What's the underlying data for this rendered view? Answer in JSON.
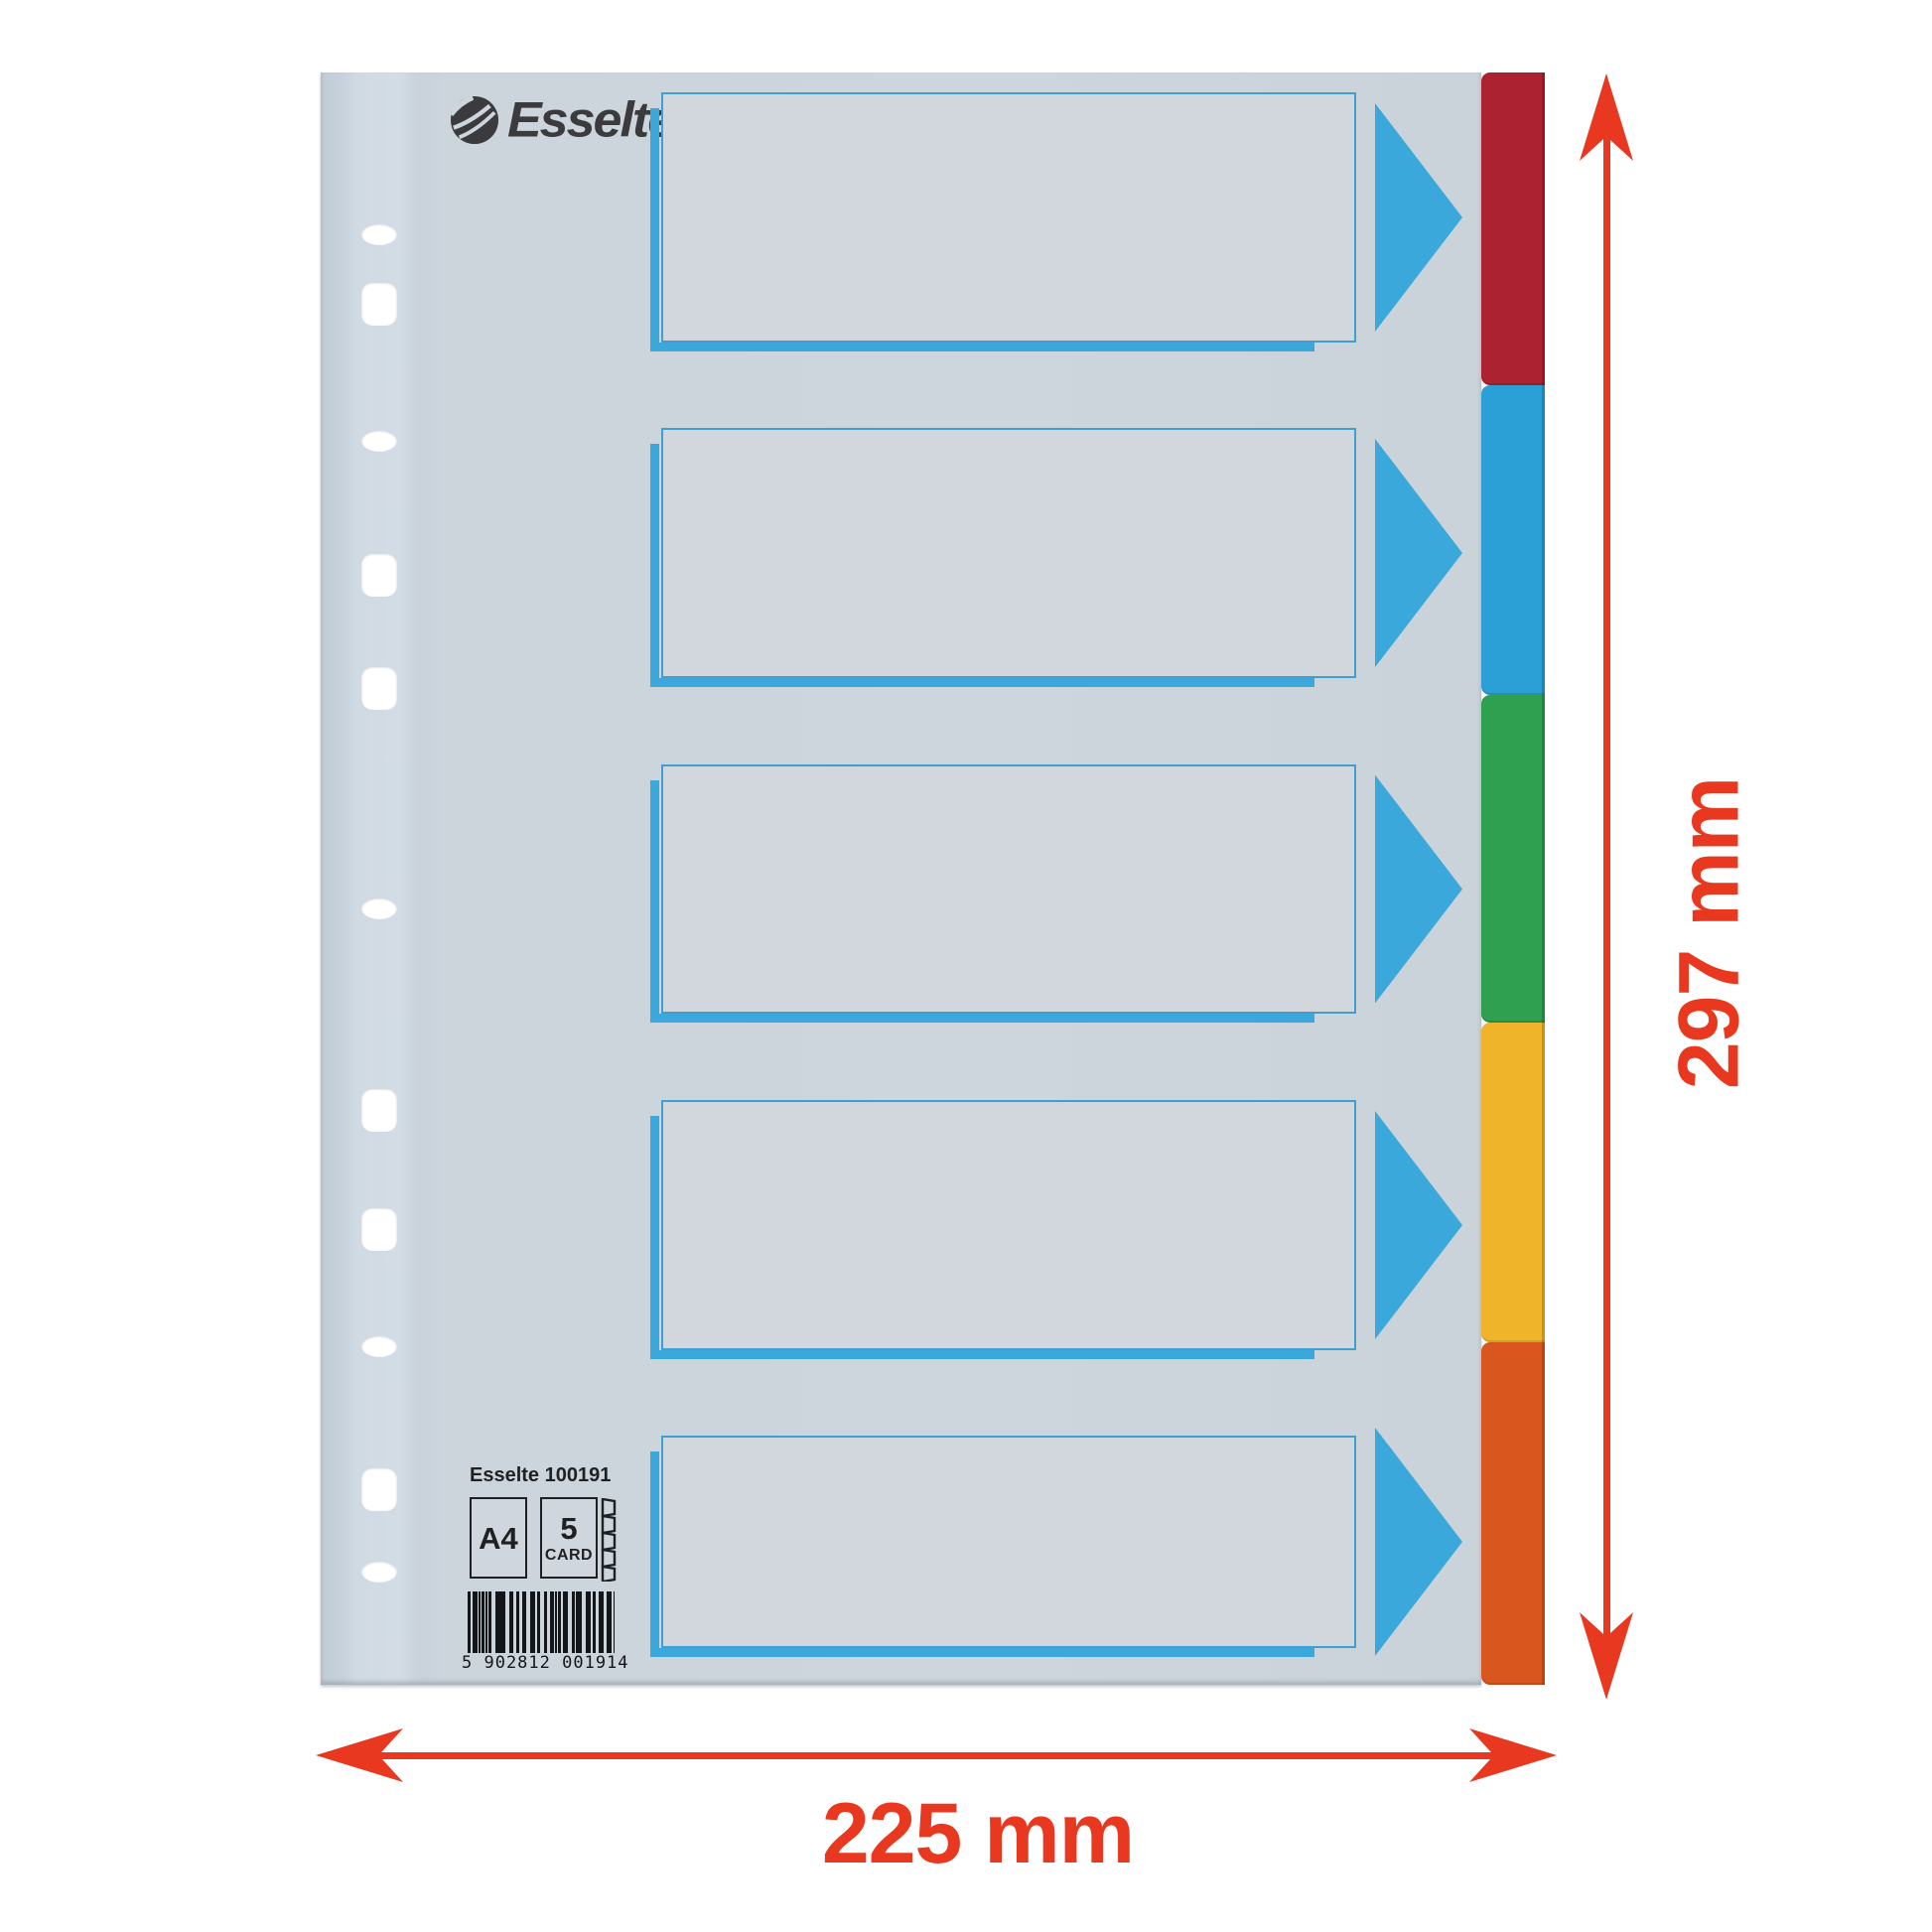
{
  "brand": {
    "logo_text": "Esselte"
  },
  "product_info": {
    "sku_line": "Esselte 100191",
    "format_badge": "A4",
    "count_badge_number": "5",
    "count_badge_caption": "CARD",
    "barcode_digits": "5 902812 001914"
  },
  "annotations": {
    "height_label": "297 mm",
    "width_label": "225 mm",
    "annotation_color": "#e8381f"
  },
  "tabs": [
    {
      "name": "red-tab",
      "color": "#ad2231"
    },
    {
      "name": "blue-tab",
      "color": "#2ba0d6"
    },
    {
      "name": "green-tab",
      "color": "#2f9f50"
    },
    {
      "name": "yellow-tab",
      "color": "#efb42a"
    },
    {
      "name": "orange-tab",
      "color": "#d9571e"
    }
  ],
  "accent": {
    "divider_blue": "#3aa8da"
  }
}
